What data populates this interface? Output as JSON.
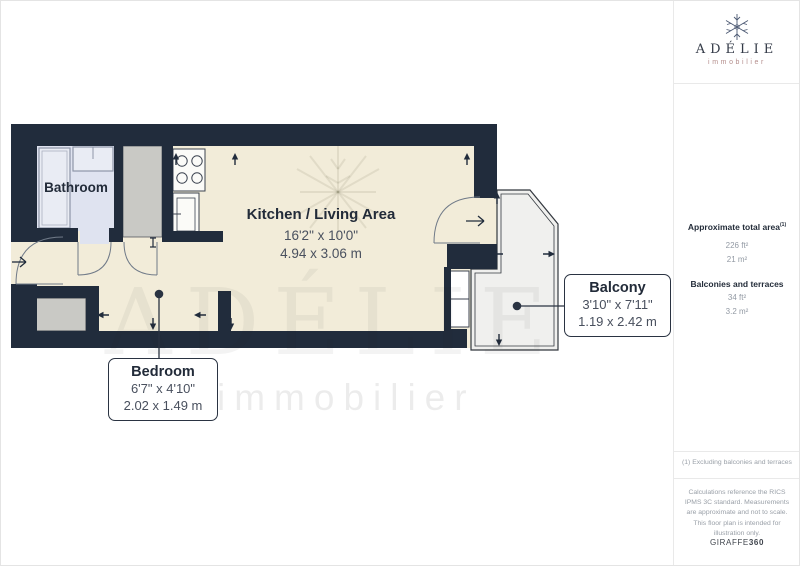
{
  "branding": {
    "logo_title": "ADÉLIE",
    "logo_subtitle": "immobilier",
    "watermark_title": "ADÉLIE",
    "watermark_subtitle": "immobilier"
  },
  "rooms": {
    "bathroom": {
      "name": "Bathroom"
    },
    "kitchen": {
      "name": "Kitchen / Living Area",
      "dim_imperial": "16'2\" x 10'0\"",
      "dim_metric": "4.94 x 3.06 m"
    },
    "balcony": {
      "name": "Balcony",
      "dim_imperial": "3'10\" x 7'11\"",
      "dim_metric": "1.19 x 2.42 m"
    },
    "bedroom": {
      "name": "Bedroom",
      "dim_imperial": "6'7\" x 4'10\"",
      "dim_metric": "2.02 x 1.49 m"
    }
  },
  "sidebar": {
    "total_area_label": "Approximate total area",
    "total_area_note_ref": "(1)",
    "total_area_ft": "226 ft²",
    "total_area_m": "21 m²",
    "balconies_label": "Balconies and terraces",
    "balconies_ft": "34 ft²",
    "balconies_m": "3.2 m²",
    "footnote": "(1) Excluding balconies and terraces",
    "disclaimer": "Calculations reference the RICS IPMS 3C standard. Measurements are approximate and not to scale. This floor plan is intended for illustration only.",
    "provider": "GIRAFFE",
    "provider_suffix": "360"
  },
  "colors": {
    "wall": "#212c3c",
    "floor": "#f2ecd9",
    "bathroom_floor": "#dfe3f0",
    "fixture": "#e9ecf4",
    "closet": "#c9c9c5",
    "balcony_floor": "#f0f0ee",
    "logo_accent": "#b48e8c",
    "muted_text": "#939aa4",
    "dark_text": "#242d3a"
  }
}
